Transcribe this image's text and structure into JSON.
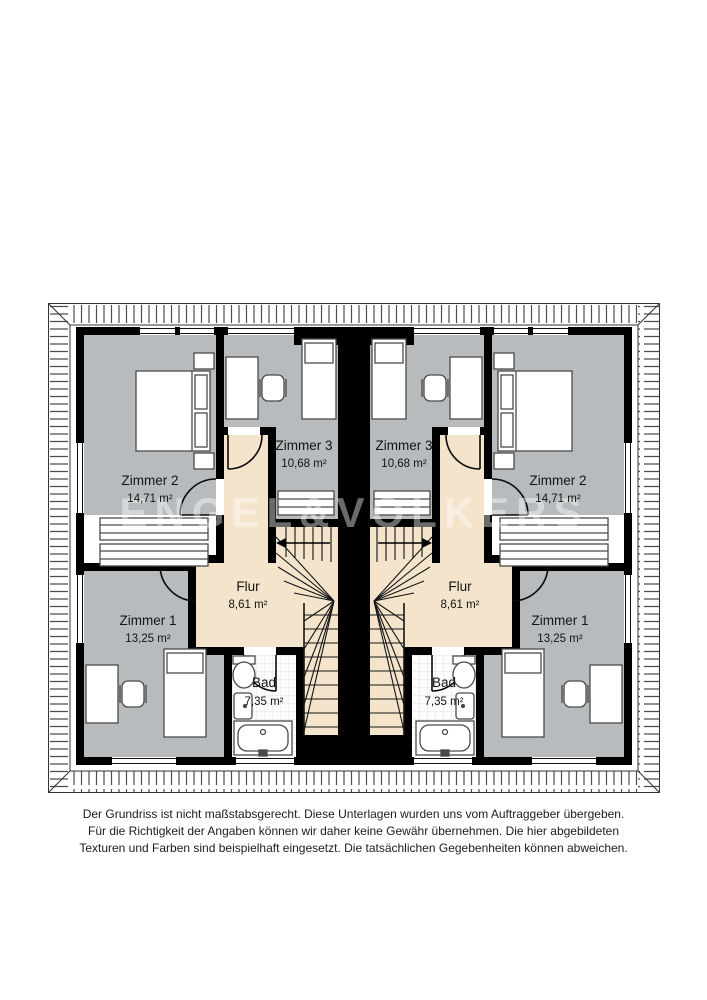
{
  "watermark": {
    "text": "ENGEL&VÖLKERS"
  },
  "plan": {
    "type": "floor-plan",
    "units": {
      "left": {
        "rooms": [
          {
            "name": "Zimmer 2",
            "area": "14,71 m²"
          },
          {
            "name": "Zimmer 3",
            "area": "10,68 m²"
          },
          {
            "name": "Zimmer 1",
            "area": "13,25 m²"
          },
          {
            "name": "Flur",
            "area": "8,61 m²"
          },
          {
            "name": "Bad",
            "area": "7,35 m²"
          }
        ]
      },
      "right": {
        "rooms": [
          {
            "name": "Zimmer 2",
            "area": "14,71 m²"
          },
          {
            "name": "Zimmer 3",
            "area": "10,68 m²"
          },
          {
            "name": "Zimmer 1",
            "area": "13,25 m²"
          },
          {
            "name": "Flur",
            "area": "8,61 m²"
          },
          {
            "name": "Bad",
            "area": "7,35 m²"
          }
        ]
      }
    },
    "colors": {
      "wall": "#000000",
      "room_floor": "#b7bbbd",
      "hall_floor": "#f3e4cb",
      "bath_floor": "#ffffff",
      "furniture_outline": "#4a4a4a"
    }
  },
  "disclaimer": {
    "line1": "Der Grundriss ist nicht maßstabsgerecht. Diese Unterlagen wurden uns vom Auftraggeber übergeben.",
    "line2": "Für die Richtigkeit der Angaben können wir daher keine Gewähr übernehmen. Die hier abgebildeten",
    "line3": "Texturen und Farben sind beispielhaft eingesetzt. Die tatsächlichen Gegebenheiten können abweichen."
  }
}
